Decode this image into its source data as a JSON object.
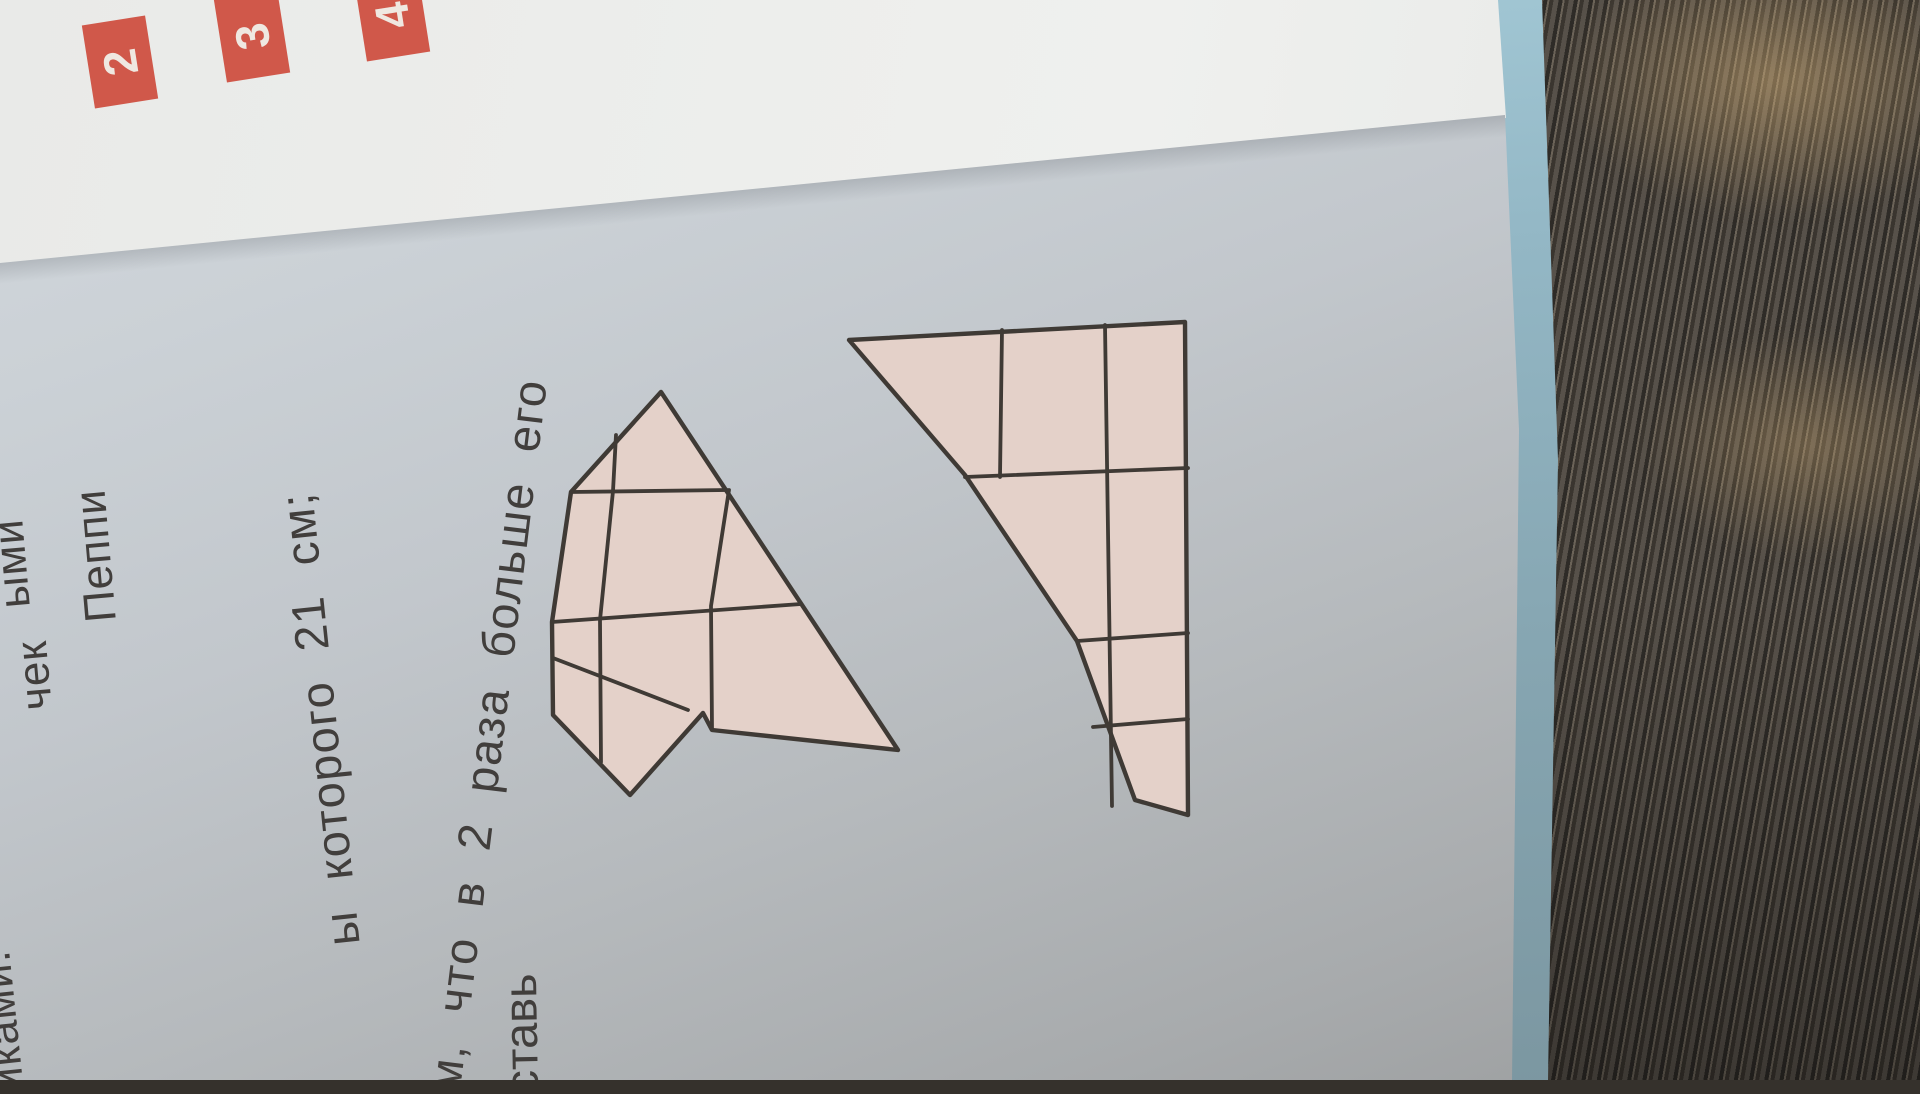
{
  "photo": {
    "description": "Photo of a Russian math textbook page rotated 90 degrees, lying on dark striped fabric",
    "colors": {
      "accent_red": "#d0584a",
      "badge_digit": "#efe8e1",
      "page_blue_grey": "#c9d0d6",
      "white_page": "#ebecea",
      "cover_edge_cyan": "#9fc6d4",
      "fabric_base": "#4e4943",
      "fabric_dark": "#2e2b27",
      "figure_fill": "#e4d1c9",
      "figure_stroke": "#3f3a35",
      "text_color": "#413e3c"
    }
  },
  "tasks": {
    "labels": [
      "2",
      "3",
      "4"
    ]
  },
  "page_text": {
    "line1_fragment": "ы которого 21 см;",
    "line2_fragment": "м, что в 2 раза больше его",
    "word_fragment": "ставь"
  },
  "margin_fragments": {
    "f_ymi": "ыми",
    "f_peppi": "Пеппи",
    "f_chek": "чек",
    "f_ikami": "иками."
  },
  "figure": {
    "note": "pink grid figure split by white diagonal band, drawn in photo coordinates",
    "left_outline": "661,392 898,750 712,730 703,713 630,795 553,715 552,622 571,492",
    "left_lines": [
      "571,492 727,490",
      "552,622 801,604",
      "553,658 688,710",
      "616,435 613,491",
      "613,491 600,620 601,762",
      "729,490 711,606 712,728"
    ],
    "right_outline": "849,340 1185,322 1188,815 1135,800 1077,641 965,475",
    "right_lines": [
      "1002,330 1000,477",
      "1105,325 1112,806",
      "965,477 1188,468",
      "1077,641 1188,633",
      "1093,727 1188,719"
    ]
  }
}
